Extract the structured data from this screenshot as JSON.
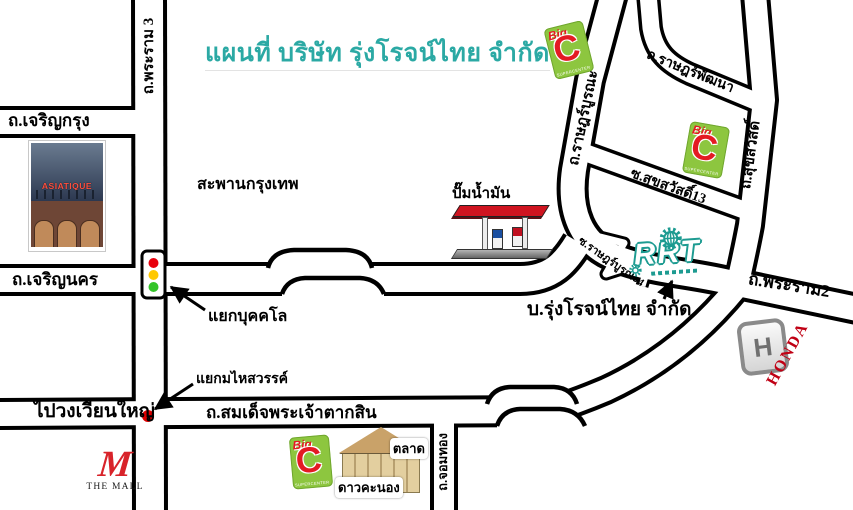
{
  "title": "แผนที่ บริษัท รุ่งโรจน์ไทย จำกัด",
  "roads": {
    "rama3": "ถ.พระราม 3",
    "charoen_krung": "ถ.เจริญกรุง",
    "krungthep_bridge": "สะพานกรุงเทพ",
    "charoen_nakhon": "ถ.เจริญนคร",
    "taksin": "ถ.สมเด็จพระเจ้าตากสิน",
    "chom_thong": "ถ.จอมทอง",
    "rat_burana": "ถ.ราษฎร์บูรณะ",
    "rat_phatthana": "ถ.ราษฎร์พัฒนา",
    "suk_sawat": "ถ.สุขสวัสดิ์",
    "suk_sawat_13": "ซ.สุขสวัสดิ์13",
    "soi_rat_burana_4": "ซ.ราษฎร์บูรณะ4",
    "phra_ram_2": "ถ.พระราม2"
  },
  "junctions": {
    "bukkhalo": "แยกบุคคโล",
    "mahaisawan": "แยกมไหสวรรค์",
    "to_wongwian_yai": "ไปวงเวียนใหญ่"
  },
  "places": {
    "company_label": "บ.รุ่งโรจน์ไทย จำกัด",
    "company_logo": "RRT",
    "gas_station": "ปั๊มน้ำมัน",
    "asiatique": "ASIATIQUE",
    "market_name": "ตลาด",
    "market_name2": "ดาวคะนอง",
    "honda": "HONDA",
    "honda_h": "H",
    "the_mall_m": "M",
    "the_mall": "THE MALL",
    "bigc_big": "Big",
    "bigc_c": "C",
    "bigc_sub": "SUPERCENTER"
  },
  "colors": {
    "title_teal": "#2BA9A4",
    "company_teal": "#1D9B91",
    "bigc_green": "#8DC63F",
    "bigc_red": "#E31B23",
    "honda_red": "#C00014",
    "mall_red": "#D8232A",
    "traffic_red": "#E8000D",
    "traffic_yellow": "#FFC800",
    "traffic_green": "#35C42A",
    "junction_dot_red": "#DD0000",
    "road_outline": "#000000"
  }
}
